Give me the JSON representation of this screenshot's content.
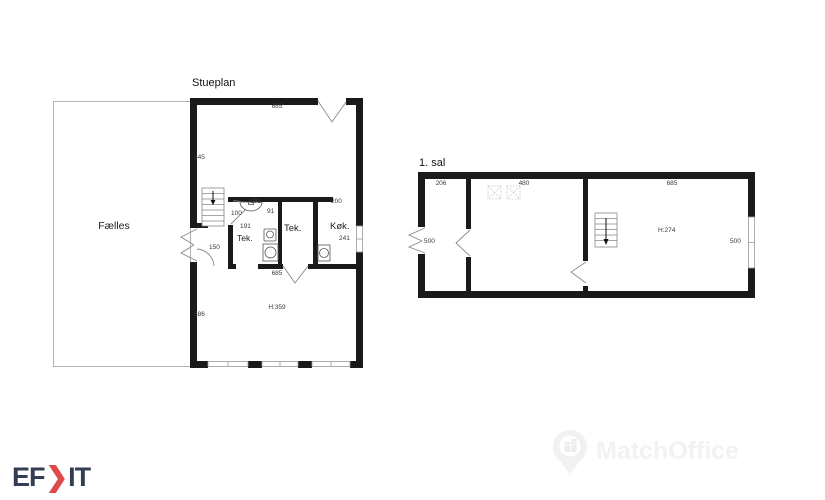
{
  "stueplan": {
    "title": "Stueplan",
    "room_labels": {
      "faelles": "Fælles",
      "tek_bath": "Tek.",
      "tek_2": "Tek.",
      "koekken": "Køk."
    },
    "dimensions": {
      "top_width": "685",
      "left_upper": "345",
      "left_lower": "386",
      "entry_door": "150",
      "stair_passage": "100",
      "bath_width": "191",
      "bath_right": "91",
      "bath_inner": "191",
      "koekken_opening": "200",
      "koekken_window": "241",
      "block_bottom": "685",
      "ceiling_height": "H:359"
    }
  },
  "first_floor": {
    "title": "1. sal",
    "dimensions": {
      "room1_width": "206",
      "room2_width": "480",
      "room3_width": "685",
      "room1_depth": "500",
      "window_right": "500",
      "ceiling_height": "H:274"
    }
  },
  "logo": {
    "prefix": "EF",
    "chevron": "❯",
    "suffix": "IT"
  },
  "watermark": {
    "brand": "MatchOffice"
  },
  "colors": {
    "wall": "#1a1a1a",
    "thin_line": "#8a8a8a",
    "dimension_text": "#3a3a3a",
    "logo_navy": "#333e55",
    "logo_red": "#e0494b",
    "watermark_gray": "#f2f2f2"
  }
}
